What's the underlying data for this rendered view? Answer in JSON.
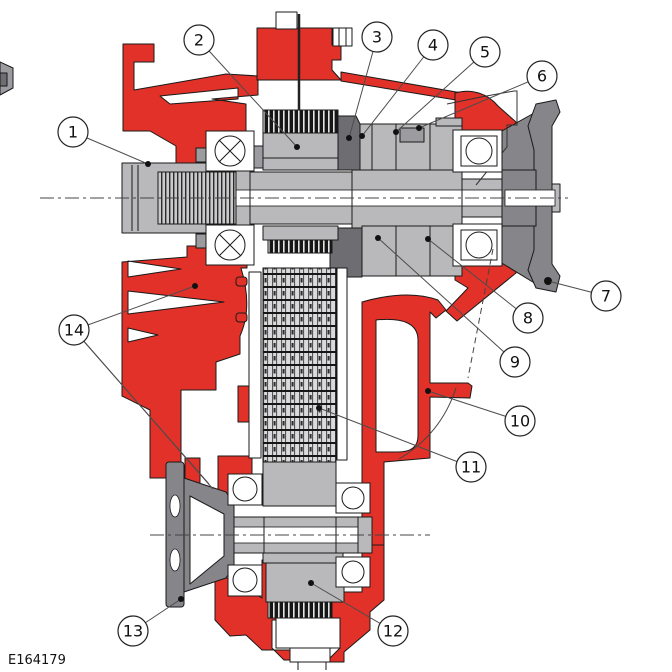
{
  "figure": {
    "code": "E164179",
    "title": "Transfer case cross-section diagram",
    "kind": "technical-illustration",
    "colors": {
      "housing_red": "#e23128",
      "part_light": "#b9b9bc",
      "part_mid": "#9c9ca0",
      "part_dark": "#85858a",
      "part_darker": "#6e6e72",
      "clutch_dark": "#1d1d1f",
      "outline": "#1a1a1a",
      "leader": "#4d4d4d",
      "background": "#ffffff"
    },
    "callout_style": {
      "radius": 15,
      "font_size": 16,
      "dot_radius": 3
    },
    "callouts": [
      {
        "label": "1",
        "cx": 73,
        "cy": 132,
        "targets": [
          [
            148,
            164
          ]
        ]
      },
      {
        "label": "2",
        "cx": 199,
        "cy": 40,
        "targets": [
          [
            297,
            147
          ]
        ]
      },
      {
        "label": "3",
        "cx": 377,
        "cy": 37,
        "targets": [
          [
            349,
            138
          ]
        ]
      },
      {
        "label": "4",
        "cx": 433,
        "cy": 45,
        "targets": [
          [
            362,
            136
          ]
        ]
      },
      {
        "label": "5",
        "cx": 485,
        "cy": 52,
        "targets": [
          [
            396,
            132
          ]
        ]
      },
      {
        "label": "6",
        "cx": 542,
        "cy": 76,
        "targets": [
          [
            419,
            128
          ]
        ]
      },
      {
        "label": "7",
        "cx": 606,
        "cy": 296,
        "targets": [
          [
            548,
            281
          ]
        ]
      },
      {
        "label": "8",
        "cx": 528,
        "cy": 318,
        "targets": [
          [
            428,
            239
          ]
        ]
      },
      {
        "label": "9",
        "cx": 515,
        "cy": 362,
        "targets": [
          [
            378,
            238
          ]
        ]
      },
      {
        "label": "10",
        "cx": 520,
        "cy": 421,
        "targets": [
          [
            428,
            391
          ]
        ]
      },
      {
        "label": "11",
        "cx": 471,
        "cy": 467,
        "targets": [
          [
            319,
            408
          ]
        ]
      },
      {
        "label": "12",
        "cx": 393,
        "cy": 631,
        "targets": [
          [
            311,
            583
          ]
        ]
      },
      {
        "label": "13",
        "cx": 133,
        "cy": 631,
        "targets": [
          [
            181,
            599
          ]
        ]
      },
      {
        "label": "14",
        "cx": 74,
        "cy": 330,
        "targets": [
          [
            195,
            286
          ],
          [
            209,
            484
          ],
          [
            213,
            489
          ]
        ]
      }
    ]
  }
}
